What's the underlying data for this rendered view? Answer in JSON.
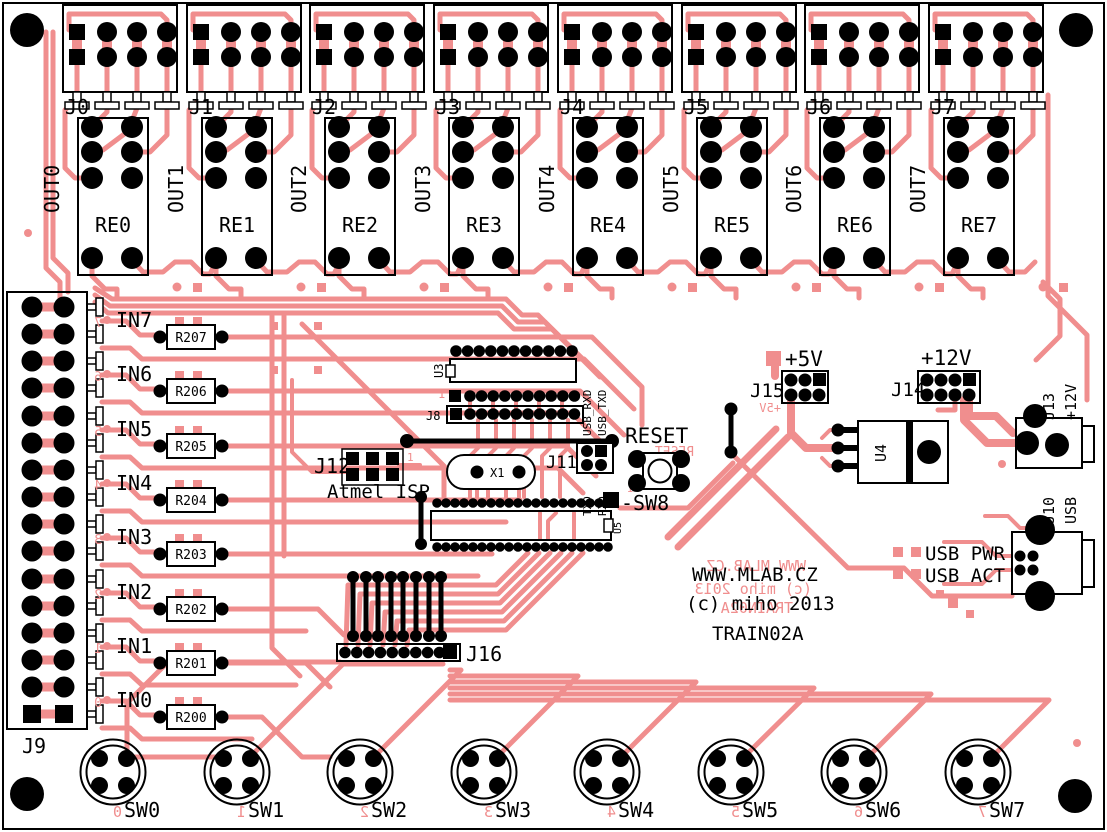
{
  "board": {
    "website": "WWW.MLAB.CZ",
    "copyright": "(c) miho 2013",
    "title": "TRAIN02A",
    "colors": {
      "trace": "#F08E8E",
      "silkscreen": "#000000",
      "pad": "#000000",
      "background": "#FFFFFF"
    }
  },
  "output_channels": [
    {
      "connector": "J0",
      "signal": "OUT0",
      "relay": "RE0"
    },
    {
      "connector": "J1",
      "signal": "OUT1",
      "relay": "RE1"
    },
    {
      "connector": "J2",
      "signal": "OUT2",
      "relay": "RE2"
    },
    {
      "connector": "J3",
      "signal": "OUT3",
      "relay": "RE3"
    },
    {
      "connector": "J4",
      "signal": "OUT4",
      "relay": "RE4"
    },
    {
      "connector": "J5",
      "signal": "OUT5",
      "relay": "RE5"
    },
    {
      "connector": "J6",
      "signal": "OUT6",
      "relay": "RE6"
    },
    {
      "connector": "J7",
      "signal": "OUT7",
      "relay": "RE7"
    }
  ],
  "input_connector": {
    "label": "J9"
  },
  "input_channels": [
    {
      "signal": "IN7",
      "resistor": "R207",
      "copper_digit": "7"
    },
    {
      "signal": "IN6",
      "resistor": "R206",
      "copper_digit": "6"
    },
    {
      "signal": "IN5",
      "resistor": "R205",
      "copper_digit": "5"
    },
    {
      "signal": "IN4",
      "resistor": "R204",
      "copper_digit": "4"
    },
    {
      "signal": "IN3",
      "resistor": "R203",
      "copper_digit": "3"
    },
    {
      "signal": "IN2",
      "resistor": "R202",
      "copper_digit": "2"
    },
    {
      "signal": "IN1",
      "resistor": "R201",
      "copper_digit": "1"
    },
    {
      "signal": "IN0",
      "resistor": "R200",
      "copper_digit": "0"
    }
  ],
  "switches": [
    {
      "label": "SW0",
      "copper_digit": "0"
    },
    {
      "label": "SW1",
      "copper_digit": "1"
    },
    {
      "label": "SW2",
      "copper_digit": "2"
    },
    {
      "label": "SW3",
      "copper_digit": "3"
    },
    {
      "label": "SW4",
      "copper_digit": "4"
    },
    {
      "label": "SW5",
      "copper_digit": "5"
    },
    {
      "label": "SW6",
      "copper_digit": "6"
    },
    {
      "label": "SW7",
      "copper_digit": "7"
    }
  ],
  "mcu": {
    "u3": "U3",
    "j8": "J8",
    "pin1": "1",
    "crystal": "X1",
    "j11": {
      "label": "J11",
      "signals_top": [
        "USB_RXD",
        "USB_TXD"
      ],
      "signals_bottom": [
        "TXD",
        "RXD"
      ]
    },
    "reset_label": "RESET",
    "reset_button": "-SW8",
    "isp": {
      "label": "J12",
      "caption": "Atmel ISP",
      "pin1": "1"
    },
    "u5": "U5",
    "j16": "J16"
  },
  "power": {
    "rail5": "+5V",
    "j15": "J15",
    "rail12": "+12V",
    "j14": "J14",
    "j13": {
      "label": "J13",
      "voltage": "+12V"
    },
    "regulator": "U4"
  },
  "usb": {
    "j10": {
      "label": "J10",
      "type": "USB"
    },
    "power_led": "USB PWR",
    "activity_led": "USB ACT"
  }
}
